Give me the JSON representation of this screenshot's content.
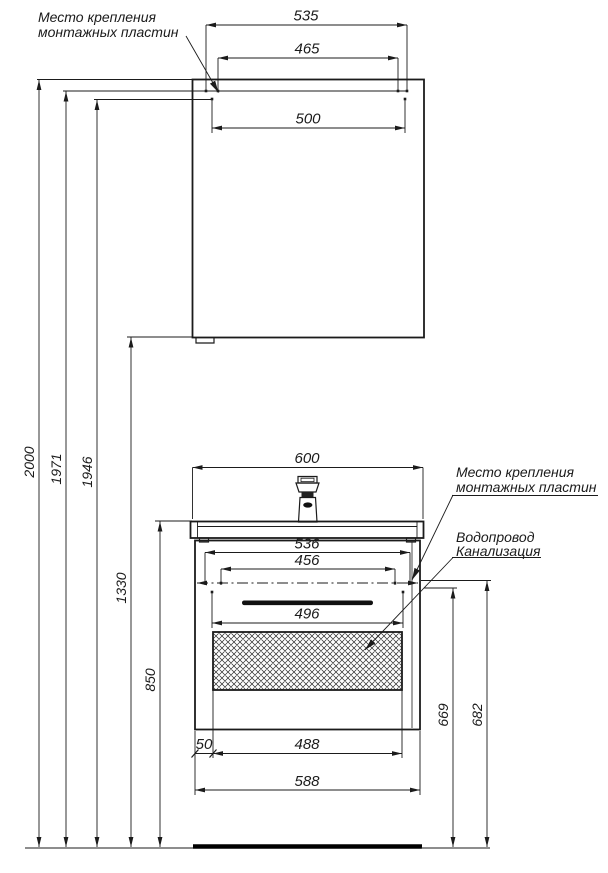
{
  "drawing": {
    "kind": "bathroom furniture installation drawing",
    "labels": {
      "mounting_top": {
        "line1": "Место крепления",
        "line2": "монтажных пластин"
      },
      "mounting_right": {
        "line1": "Место крепления",
        "line2": "монтажных пластин"
      },
      "plumbing": {
        "line1": "Водопровод",
        "line2": "Канализация"
      }
    },
    "dims": {
      "d535": "535",
      "d465": "465",
      "d500": "500",
      "d2000": "2000",
      "d1971": "1971",
      "d1946": "1946",
      "d1330": "1330",
      "d850": "850",
      "d600": "600",
      "d536": "536",
      "d456": "456",
      "d496": "496",
      "d50": "50",
      "d488": "488",
      "d588": "588",
      "d669": "669",
      "d682": "682"
    },
    "colors": {
      "line": "#1b1b1b",
      "background": "#ffffff"
    }
  }
}
